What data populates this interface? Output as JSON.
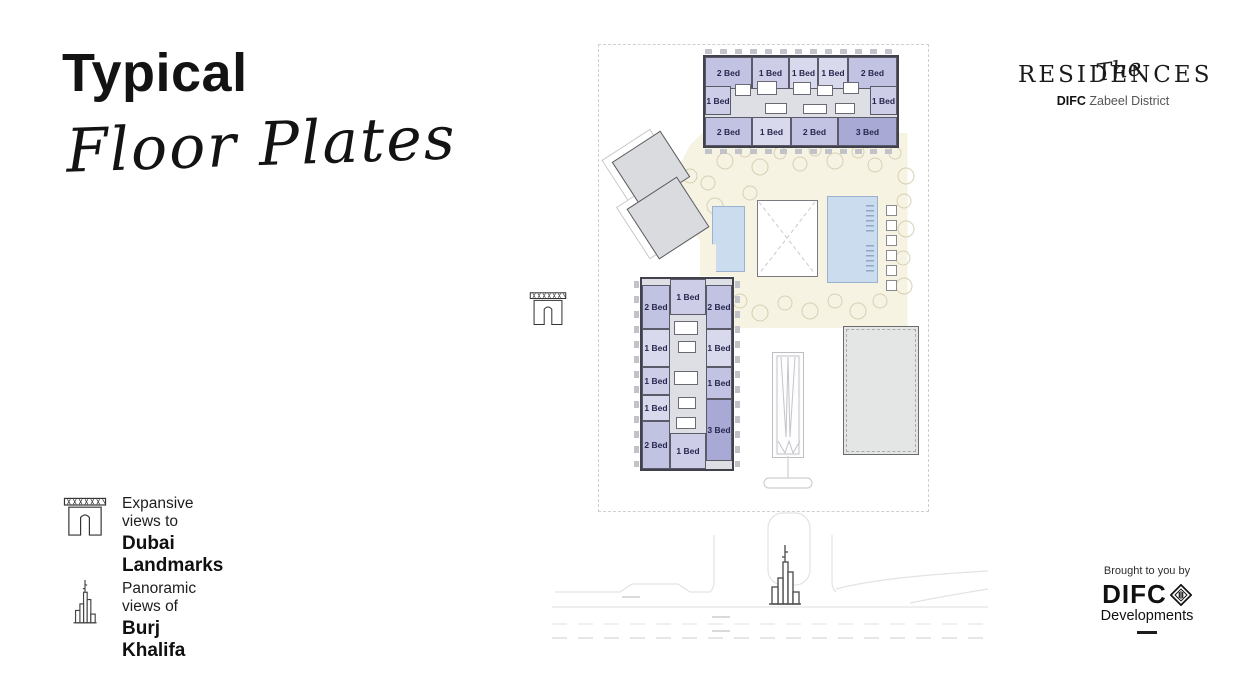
{
  "slide": {
    "title": {
      "line1": "Typical",
      "line2": "Floor Plates"
    },
    "brand": {
      "script": "The",
      "name": "RESIDENCES",
      "org": "DIFC",
      "district": "Zabeel District"
    },
    "legend": {
      "items": [
        {
          "icon": "dubai-frame-icon",
          "line1": "Expansive views to",
          "line2": "Dubai Landmarks"
        },
        {
          "icon": "burj-khalifa-icon",
          "line1": "Panoramic views of",
          "line2": "Burj Khalifa"
        }
      ]
    },
    "footer": {
      "tagline": "Brought to you by",
      "org": "DIFC",
      "org_sub": "Developments"
    }
  },
  "plan": {
    "colors": {
      "one_bed_light": "#d9d9ee",
      "one_bed": "#cdcde8",
      "two_bed": "#c2c3e3",
      "three_bed": "#a8aad5",
      "courtyard": "#f6f3e2",
      "pool": "#cadcee",
      "unit_label": "#27274e"
    },
    "north_wing": {
      "units": [
        {
          "label": "2 Bed"
        },
        {
          "label": "1 Bed"
        },
        {
          "label": "1 Bed"
        },
        {
          "label": "1 Bed"
        },
        {
          "label": "2 Bed"
        },
        {
          "label": "1 Bed"
        },
        {
          "label": "1 Bed"
        },
        {
          "label": "2 Bed"
        },
        {
          "label": "1 Bed"
        },
        {
          "label": "2 Bed"
        },
        {
          "label": "3 Bed"
        }
      ]
    },
    "west_wing": {
      "units": [
        {
          "label": "1 Bed"
        },
        {
          "label": "2 Bed"
        },
        {
          "label": "2 Bed"
        },
        {
          "label": "1 Bed"
        },
        {
          "label": "1 Bed"
        },
        {
          "label": "1 Bed"
        },
        {
          "label": "1 Bed"
        },
        {
          "label": "1 Bed"
        },
        {
          "label": "2 Bed"
        },
        {
          "label": "3 Bed"
        },
        {
          "label": "1 Bed"
        }
      ]
    }
  }
}
